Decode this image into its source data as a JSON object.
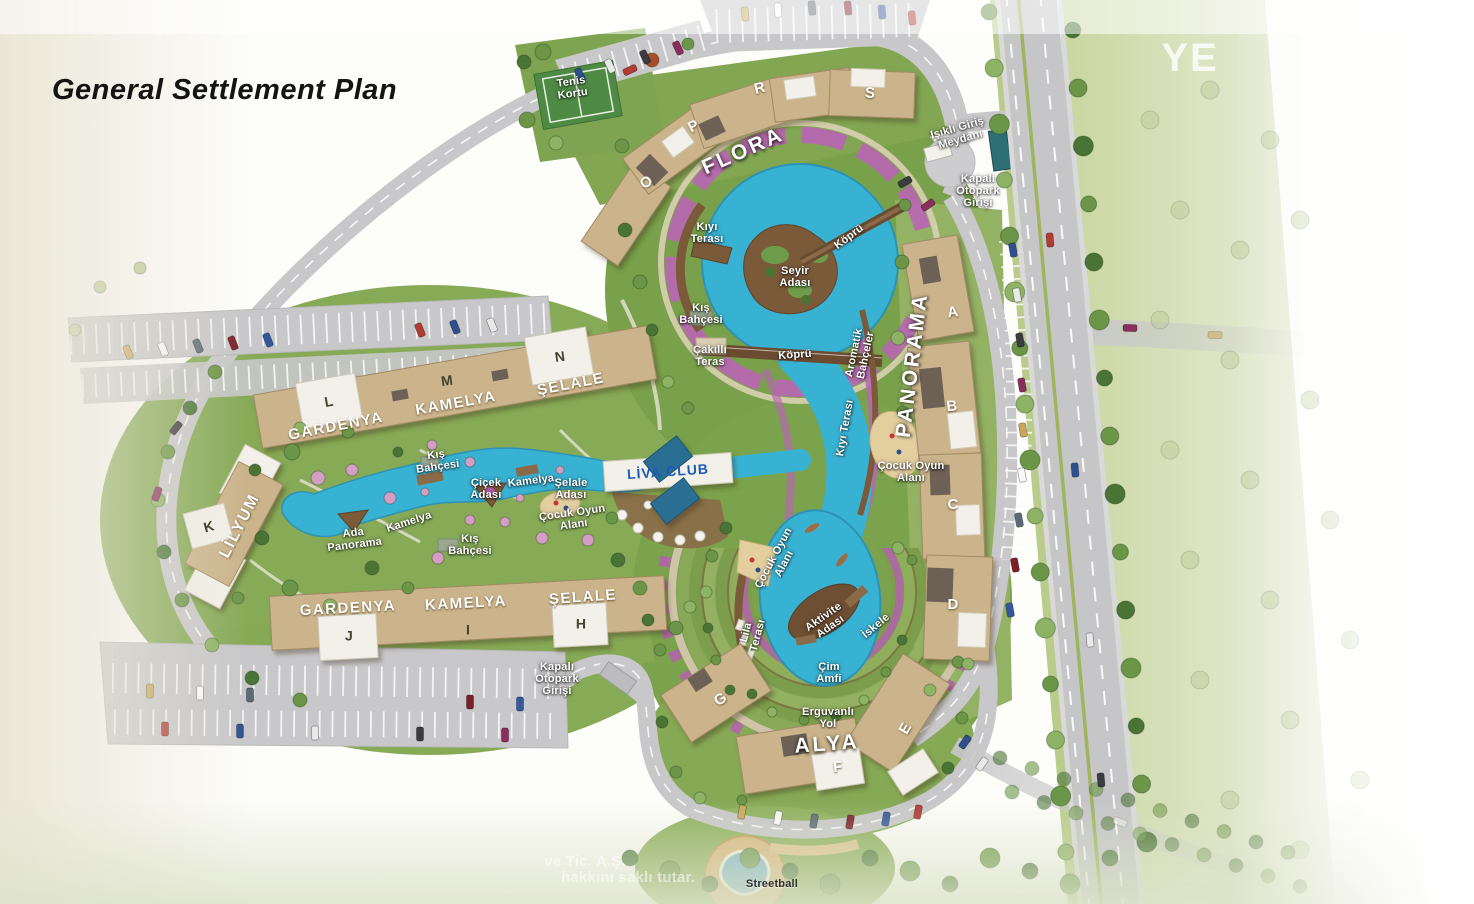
{
  "header": {
    "title": "General Settlement Plan"
  },
  "map": {
    "colors": {
      "water": "#38b2d3",
      "pool": "#2a6e94",
      "building_tan": "#cbb48c",
      "roof_white": "#f2f0e8",
      "road_gray": "#c8c8ca",
      "green": "#7fa451",
      "green_pale": "#c8d69f",
      "flower_purple": "#b660b2",
      "deck_brown": "#7b5a3a",
      "sand": "#e3cf9e",
      "liva_blue": "#1d5bb5",
      "ramp_teal": "#2e6f75",
      "court_green": "#4f8a44",
      "median_green": "#9fb45f"
    },
    "labels": [
      {
        "id": "tenis-kortu",
        "text": "Tenis\nKortu",
        "x": 572,
        "y": 88,
        "rot": -8,
        "cls": "sm"
      },
      {
        "id": "flora-o",
        "text": "O",
        "x": 647,
        "y": 183,
        "rot": -42,
        "cls": "roofletter"
      },
      {
        "id": "flora-p",
        "text": "P",
        "x": 694,
        "y": 127,
        "rot": -28,
        "cls": "roofletter"
      },
      {
        "id": "flora-r",
        "text": "R",
        "x": 760,
        "y": 89,
        "rot": -14,
        "cls": "roofletter"
      },
      {
        "id": "flora-s",
        "text": "S",
        "x": 870,
        "y": 94,
        "rot": 3,
        "cls": "roofletter"
      },
      {
        "id": "flora",
        "text": "FLORA",
        "x": 743,
        "y": 151,
        "rot": -24,
        "cls": "district"
      },
      {
        "id": "isikli-giris-meydani",
        "text": "Işıklı Giriş\nMeydanı",
        "x": 959,
        "y": 134,
        "rot": -16,
        "cls": "sm"
      },
      {
        "id": "kapali-otopark-girisi-top",
        "text": "Kapalı\nOtopark\nGirişi",
        "x": 978,
        "y": 191,
        "rot": 0,
        "cls": "sm"
      },
      {
        "id": "kiyi-terasi-nw",
        "text": "Kıyı\nTerası",
        "x": 707,
        "y": 233,
        "rot": 0,
        "cls": "sm"
      },
      {
        "id": "kopru-ne",
        "text": "Köprü",
        "x": 849,
        "y": 237,
        "rot": -37,
        "cls": "sm"
      },
      {
        "id": "seyir-adasi",
        "text": "Seyir\nAdası",
        "x": 795,
        "y": 277,
        "rot": 0,
        "cls": "sm"
      },
      {
        "id": "kis-bahcesi-nw",
        "text": "Kış\nBahçesi",
        "x": 701,
        "y": 314,
        "rot": 0,
        "cls": "sm"
      },
      {
        "id": "cakilli-teras",
        "text": "Çakıllı\nTeras",
        "x": 710,
        "y": 356,
        "rot": 0,
        "cls": "sm"
      },
      {
        "id": "kopru-mid",
        "text": "Köprü",
        "x": 795,
        "y": 355,
        "rot": -4,
        "cls": "sm"
      },
      {
        "id": "aromatik-bahceler",
        "text": "Aromatik\nBahçeler",
        "x": 860,
        "y": 354,
        "rot": -78,
        "cls": "sm"
      },
      {
        "id": "panorama",
        "text": "PANORAMA",
        "x": 912,
        "y": 365,
        "rot": -83,
        "cls": "district"
      },
      {
        "id": "blok-a",
        "text": "A",
        "x": 953,
        "y": 313,
        "rot": -8,
        "cls": "roofletter"
      },
      {
        "id": "blok-b",
        "text": "B",
        "x": 952,
        "y": 407,
        "rot": -5,
        "cls": "roofletter"
      },
      {
        "id": "kiyi-terasi-e",
        "text": "Kıyı Terası",
        "x": 845,
        "y": 428,
        "rot": -80,
        "cls": "sm"
      },
      {
        "id": "cocuk-oyun-alani-e",
        "text": "Çocuk Oyun\nAlanı",
        "x": 911,
        "y": 472,
        "rot": 0,
        "cls": "sm"
      },
      {
        "id": "blok-c",
        "text": "C",
        "x": 953,
        "y": 505,
        "rot": 0,
        "cls": "roofletter"
      },
      {
        "id": "blok-d",
        "text": "D",
        "x": 953,
        "y": 605,
        "rot": 0,
        "cls": "roofletter"
      },
      {
        "id": "iskele",
        "text": "İskele",
        "x": 876,
        "y": 626,
        "rot": -40,
        "cls": "sm"
      },
      {
        "id": "gardenya-n",
        "text": "GARDENYA",
        "x": 336,
        "y": 427,
        "rot": -11,
        "cls": "bname"
      },
      {
        "id": "blok-l",
        "text": "L",
        "x": 329,
        "y": 402,
        "rot": -10,
        "cls": "darkletter"
      },
      {
        "id": "kamelya-n",
        "text": "KAMELYA",
        "x": 456,
        "y": 404,
        "rot": -10,
        "cls": "bname"
      },
      {
        "id": "blok-m",
        "text": "M",
        "x": 447,
        "y": 381,
        "rot": -8,
        "cls": "darkletter"
      },
      {
        "id": "selale-n",
        "text": "ŞELALE",
        "x": 571,
        "y": 385,
        "rot": -11,
        "cls": "bname"
      },
      {
        "id": "blok-n",
        "text": "N",
        "x": 560,
        "y": 357,
        "rot": -8,
        "cls": "darkletter"
      },
      {
        "id": "kis-bahcesi-c",
        "text": "Kış\nBahçesi",
        "x": 437,
        "y": 461,
        "rot": -8,
        "cls": "sm"
      },
      {
        "id": "cicek-adasi",
        "text": "Çiçek\nAdası",
        "x": 486,
        "y": 489,
        "rot": 0,
        "cls": "sm"
      },
      {
        "id": "kamelya-c",
        "text": "Kamelya",
        "x": 531,
        "y": 481,
        "rot": -7,
        "cls": "sm"
      },
      {
        "id": "selale-adasi",
        "text": "Şelale\nAdası",
        "x": 571,
        "y": 489,
        "rot": 0,
        "cls": "sm"
      },
      {
        "id": "liva-club",
        "text": "LİVA CLUB",
        "x": 668,
        "y": 472,
        "rot": -4,
        "cls": "liva"
      },
      {
        "id": "kamelya-w",
        "text": "Kamelya",
        "x": 409,
        "y": 522,
        "rot": -18,
        "cls": "sm"
      },
      {
        "id": "kis-bahcesi-s",
        "text": "Kış\nBahçesi",
        "x": 470,
        "y": 545,
        "rot": 0,
        "cls": "sm"
      },
      {
        "id": "cocuk-oyun-alani-c",
        "text": "Çocuk Oyun\nAlanı",
        "x": 573,
        "y": 519,
        "rot": -8,
        "cls": "sm"
      },
      {
        "id": "lilyum",
        "text": "LİLYUM",
        "x": 240,
        "y": 526,
        "rot": -63,
        "cls": "onbldg"
      },
      {
        "id": "blok-k",
        "text": "K",
        "x": 209,
        "y": 527,
        "rot": -15,
        "cls": "darkletter"
      },
      {
        "id": "ada-panorama",
        "text": "Ada\nPanorama",
        "x": 354,
        "y": 539,
        "rot": -7,
        "cls": "sm"
      },
      {
        "id": "gardenya-s",
        "text": "GARDENYA",
        "x": 348,
        "y": 609,
        "rot": -3,
        "cls": "bname"
      },
      {
        "id": "blok-j",
        "text": "J",
        "x": 349,
        "y": 636,
        "rot": 0,
        "cls": "darkletter"
      },
      {
        "id": "kamelya-s",
        "text": "KAMELYA",
        "x": 466,
        "y": 604,
        "rot": -3,
        "cls": "bname"
      },
      {
        "id": "blok-i",
        "text": "I",
        "x": 468,
        "y": 630,
        "rot": 0,
        "cls": "darkletter"
      },
      {
        "id": "selale-s",
        "text": "ŞELALE",
        "x": 583,
        "y": 598,
        "rot": -4,
        "cls": "bname"
      },
      {
        "id": "blok-h",
        "text": "H",
        "x": 581,
        "y": 624,
        "rot": 0,
        "cls": "darkletter"
      },
      {
        "id": "kapali-otopark-girisi-sw",
        "text": "Kapalı\nOtopark\nGirişi",
        "x": 557,
        "y": 679,
        "rot": 0,
        "cls": "sm"
      },
      {
        "id": "cocuk-oyun-alani-s",
        "text": "Çocuk Oyun\nAlanı",
        "x": 779,
        "y": 561,
        "rot": -62,
        "cls": "sm"
      },
      {
        "id": "lila-terasi",
        "text": "Lila\nTerası",
        "x": 752,
        "y": 634,
        "rot": -75,
        "cls": "sm"
      },
      {
        "id": "aktivite-adasi",
        "text": "Aktivite\nAdası",
        "x": 827,
        "y": 622,
        "rot": -35,
        "cls": "sm"
      },
      {
        "id": "cim-amfi",
        "text": "Çim\nAmfi",
        "x": 829,
        "y": 673,
        "rot": 0,
        "cls": "sm"
      },
      {
        "id": "erguvanli-yol",
        "text": "Erguvanlı\nYol",
        "x": 828,
        "y": 718,
        "rot": 0,
        "cls": "sm"
      },
      {
        "id": "alya",
        "text": "ALYA",
        "x": 827,
        "y": 744,
        "rot": -4,
        "cls": "district"
      },
      {
        "id": "blok-g",
        "text": "G",
        "x": 721,
        "y": 700,
        "rot": -35,
        "cls": "roofletter"
      },
      {
        "id": "blok-f",
        "text": "F",
        "x": 838,
        "y": 768,
        "rot": -5,
        "cls": "roofletter"
      },
      {
        "id": "blok-e",
        "text": "E",
        "x": 906,
        "y": 729,
        "rot": -60,
        "cls": "roofletter"
      },
      {
        "id": "streetball",
        "text": "Streetball",
        "x": 772,
        "y": 884,
        "rot": 0,
        "cls": "dark"
      },
      {
        "id": "watermark-1",
        "text": "ve Tic. A.Ş.",
        "x": 585,
        "y": 862,
        "rot": 0,
        "cls": "wm"
      },
      {
        "id": "watermark-2",
        "text": "hakkını saklı tutar.",
        "x": 628,
        "y": 878,
        "rot": 0,
        "cls": "wm"
      },
      {
        "id": "watermark-ye",
        "text": "YE",
        "x": 1190,
        "y": 58,
        "rot": 0,
        "cls": "wmbig"
      }
    ]
  }
}
